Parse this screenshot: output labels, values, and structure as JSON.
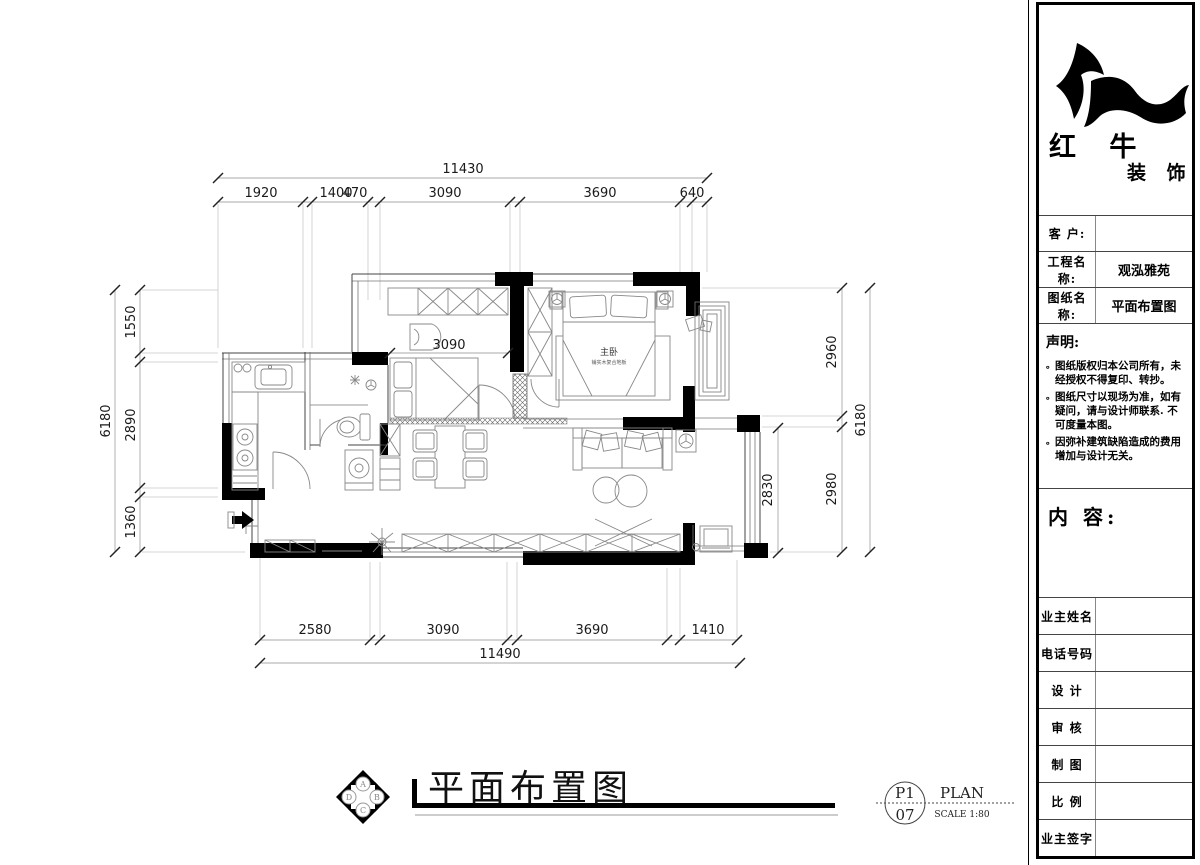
{
  "drawing": {
    "title": "平面布置图",
    "inner_dimension": "3090",
    "room_labels": [
      {
        "name": "主卧",
        "sub": "铺实木复合地板"
      }
    ],
    "dimensions": {
      "top": {
        "overall": "11430",
        "segments": [
          "1920",
          "1400",
          "470",
          "3090",
          "3690",
          "640"
        ]
      },
      "bottom": {
        "overall": "11490",
        "segments": [
          "2580",
          "3090",
          "3690",
          "1410"
        ]
      },
      "left": {
        "overall": "6180",
        "segments": [
          "1550",
          "2890",
          "1360"
        ]
      },
      "right": {
        "overall": "6180",
        "segments": [
          "2960",
          "2980"
        ],
        "inner": "2830"
      }
    },
    "compass": {
      "letters": [
        "A",
        "B",
        "C",
        "D"
      ]
    },
    "stamp": {
      "page": "P1",
      "total": "07",
      "type": "PLAN",
      "scale": "SCALE 1:80"
    }
  },
  "title_block": {
    "company_name_line1": "红 牛",
    "company_name_line2": "装 饰",
    "fields": [
      {
        "label": "客  户:",
        "value": ""
      },
      {
        "label": "工程名称:",
        "value": "观泓雅苑"
      },
      {
        "label": "图纸名称:",
        "value": "平面布置图"
      }
    ],
    "statement": {
      "title": "声明:",
      "bullet": "。",
      "items": [
        "图纸版权归本公司所有，未经授权不得复印、转抄。",
        "图纸尺寸以现场为准，如有疑问，请与设计师联系. 不可度量本图。",
        "因弥补建筑缺陷造成的费用增加与设计无关。"
      ]
    },
    "content_label": "内 容:",
    "signature_rows": [
      "业主姓名",
      "电话号码",
      "设 计",
      "审 核",
      "制 图",
      "比 例",
      "业主签字"
    ]
  }
}
